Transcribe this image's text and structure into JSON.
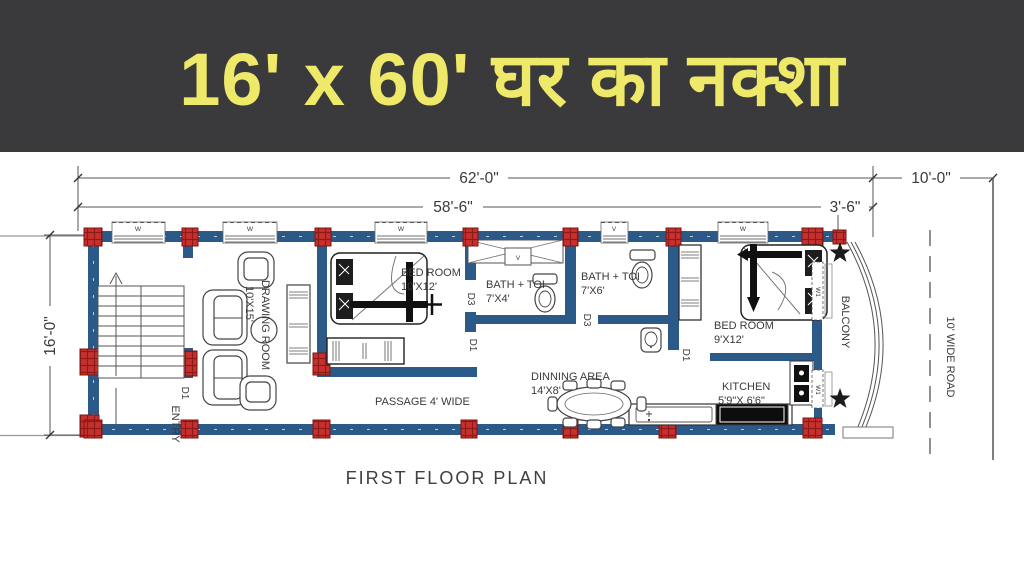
{
  "banner": {
    "title": "16' x 60' घर का नक्शा",
    "bg": "#3a3a3c",
    "text_color": "#efe96a"
  },
  "plan": {
    "caption": "FIRST FLOOR PLAN",
    "dimensions": {
      "overall": "62'-0\"",
      "inner": "58'-6\"",
      "balcony": "3'-6\"",
      "road": "10'-0\"",
      "side": "16'-0\""
    },
    "rooms": {
      "drawing": {
        "name": "DRAWING ROOM",
        "size": "10'X15'"
      },
      "bed1": {
        "name": "BED ROOM",
        "size": "10'X12'"
      },
      "bath1": {
        "name": "BATH + TOI",
        "size": "7'X4'"
      },
      "bath2": {
        "name": "BATH + TOI",
        "size": "7'X6'"
      },
      "bed2": {
        "name": "BED ROOM",
        "size": "9'X12'"
      },
      "kitchen": {
        "name": "KITCHEN",
        "size": "5'9\"X 6'6\""
      },
      "dining": {
        "name": "DINNING AREA",
        "size": "14'X8'"
      },
      "passage": {
        "name": "PASSAGE  4' WIDE"
      },
      "balcony": {
        "name": "BALCONY"
      },
      "entry": {
        "name": "ENTRY"
      }
    },
    "doors": {
      "d1": "D1",
      "d3": "D3"
    },
    "windows": {
      "w": "W",
      "w1": "W1",
      "v": "V"
    },
    "road_label": "10' WIDE ROAD",
    "colors": {
      "wall": "#2b5a88",
      "column": "#c8302e",
      "line": "#555555"
    }
  }
}
